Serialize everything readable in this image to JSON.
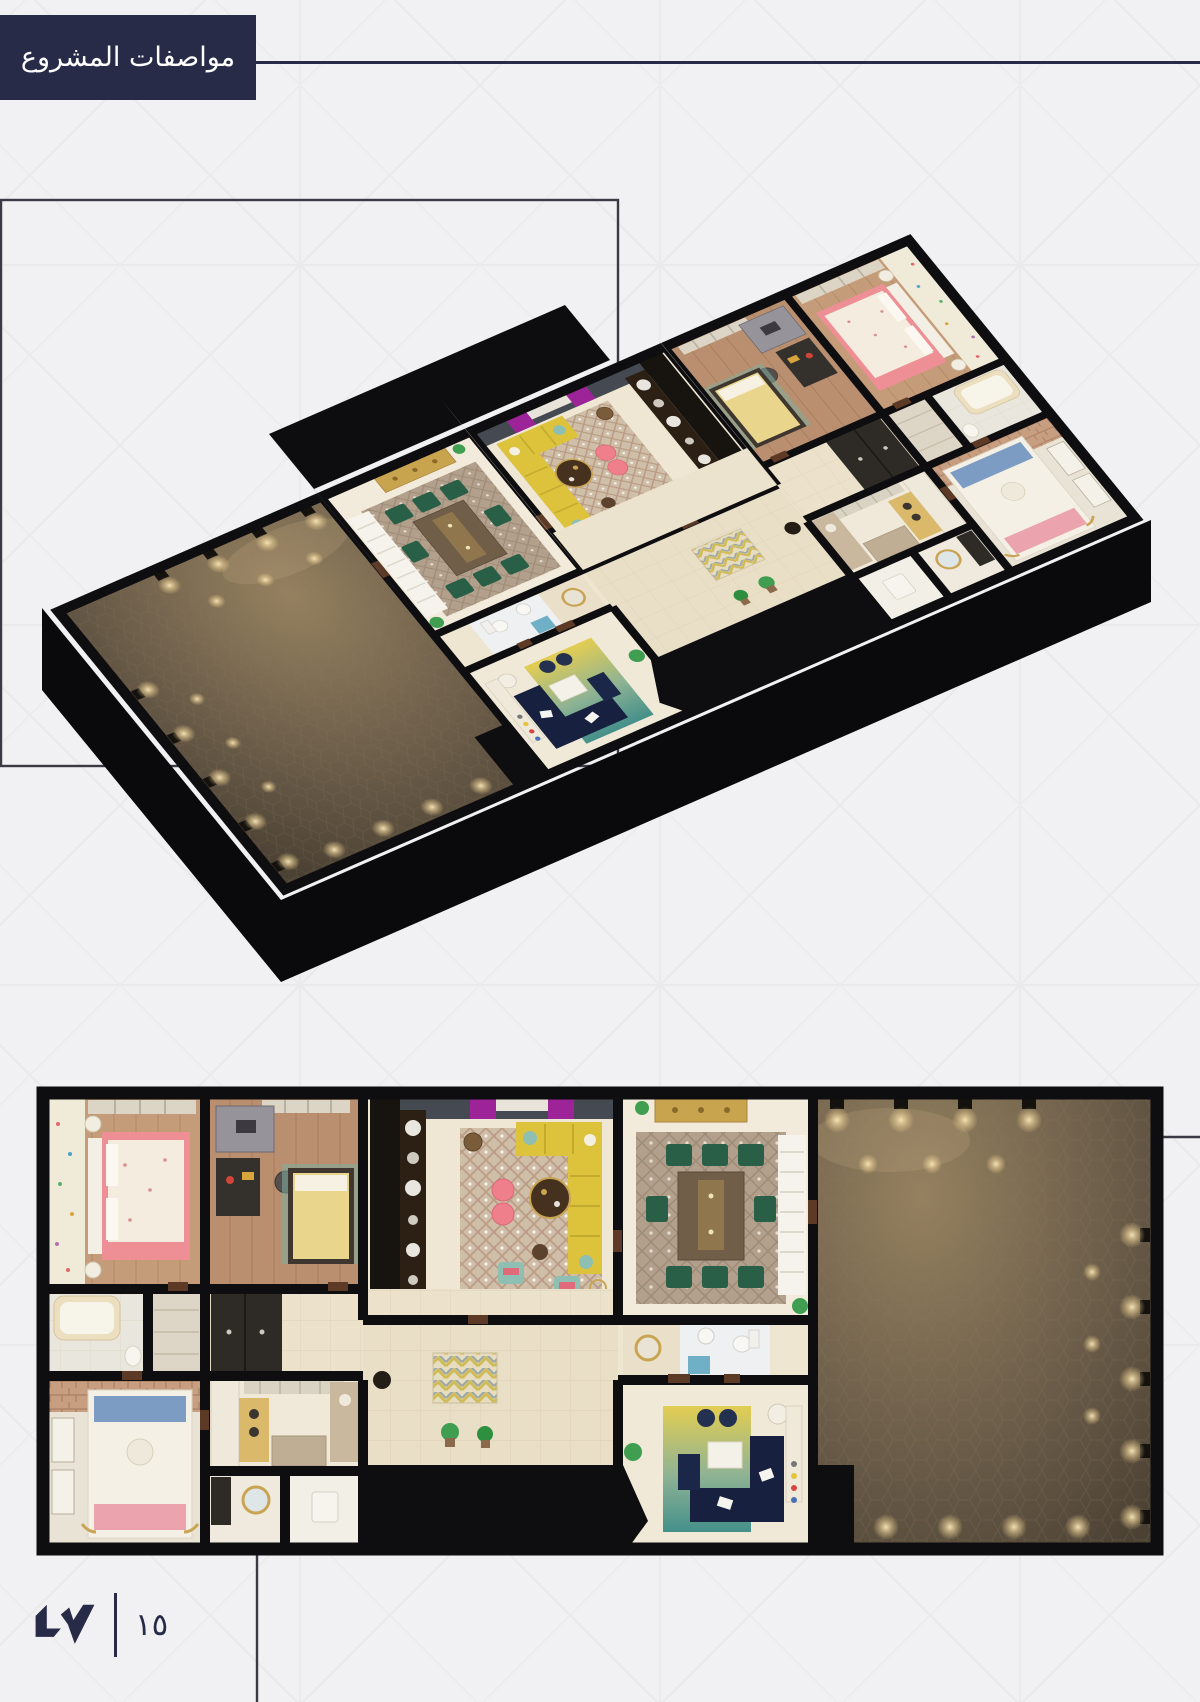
{
  "header": {
    "title": "مواصفات المشروع"
  },
  "footer": {
    "page_number": "١٥"
  },
  "figures": {
    "isometric": "isometric-3d-apartment-floorplan-render",
    "top_down": "top-down-3d-apartment-floorplan-render"
  },
  "theme": {
    "navy": "#272b48",
    "background": "#f1f0f2",
    "pattern_line": "#e9e8eb",
    "wall_black": "#0e0d0f",
    "floor_beige": "#efe6d2",
    "majlis_brown": "#6e5f4b",
    "wood_floor": "#c59c79",
    "accent_pink": "#ee8e95",
    "accent_yellow": "#ddc33b",
    "accent_green": "#2a5f47",
    "sofa_navy": "#17213f",
    "accent_teal": "#8fbfb2",
    "accent_gold": "#c9a452",
    "accent_purple": "#9c2398",
    "wall_face_blue": "#5b6b86"
  }
}
